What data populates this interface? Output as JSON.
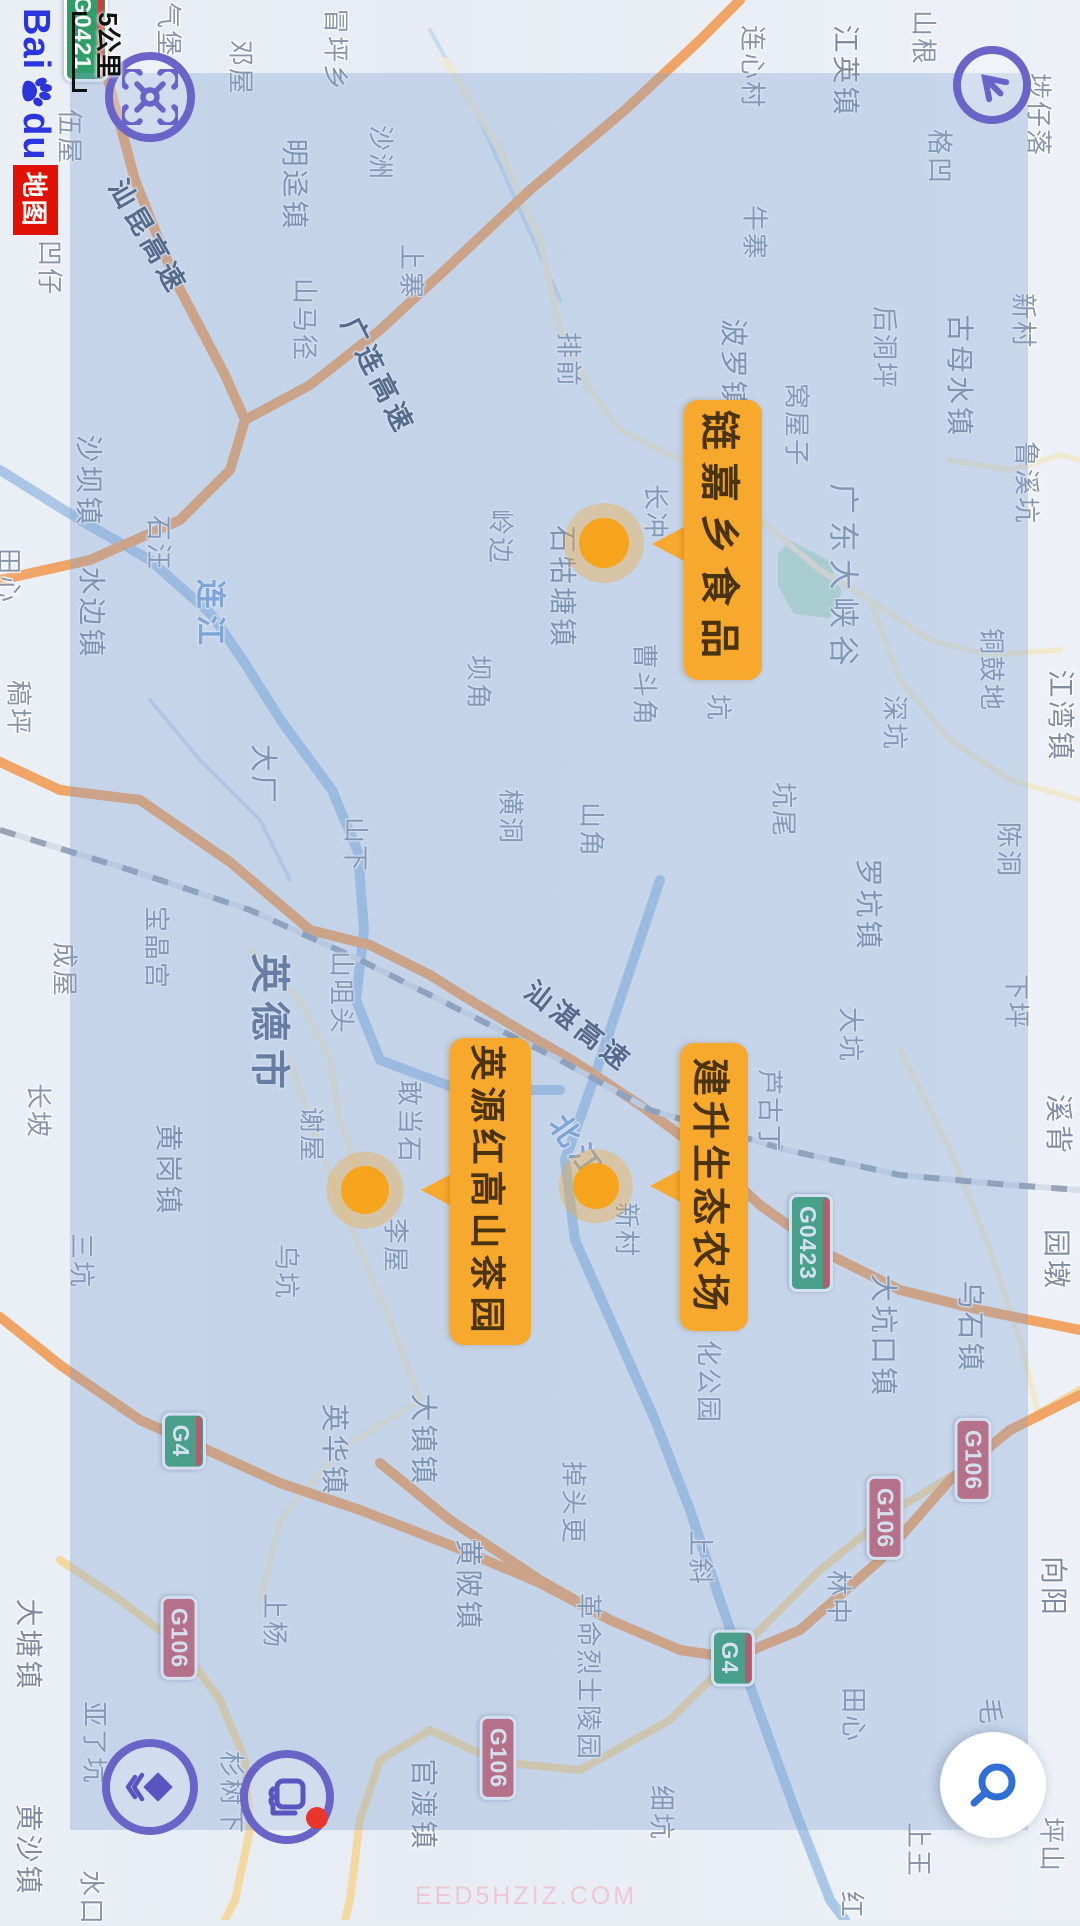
{
  "app": {
    "brand": {
      "bai": "Bai",
      "du": "du",
      "suffix": "地图"
    },
    "scale_label": "5公里",
    "watermark": "EED5HZIZ.COM"
  },
  "colors": {
    "accent_purple": "#6a64c8",
    "poi_orange": "#f7a92d",
    "marker_orange": "#f7a41d",
    "shield_green": "#2f9e68",
    "shield_red": "#cf5a66",
    "search_blue": "#2f6fd6",
    "overlay_blue": "rgba(125,160,208,0.33)",
    "notify_red": "#e8362c"
  },
  "poi_callouts": [
    {
      "label": "链嘉乡食品",
      "box": {
        "x": 400,
        "y": 318,
        "w": 280,
        "h": 78,
        "fs": 40,
        "ls": 12
      },
      "tri": {
        "x": 544,
        "y": 396
      },
      "marker": {
        "x": 543,
        "y": 476,
        "r": 25
      }
    },
    {
      "label": "英源红高山茶园",
      "box": {
        "x": 1038,
        "y": 549,
        "w": 307,
        "h": 81,
        "fs": 36,
        "ls": 6
      },
      "tri": {
        "x": 1190,
        "y": 627
      },
      "marker": {
        "x": 1190,
        "y": 715,
        "r": 24
      }
    },
    {
      "label": "建升生态农场",
      "box": {
        "x": 1043,
        "y": 332,
        "w": 288,
        "h": 68,
        "fs": 38,
        "ls": 5
      },
      "tri": {
        "x": 1186,
        "y": 398
      },
      "marker": {
        "x": 1186,
        "y": 484,
        "r": 23
      }
    }
  ],
  "road_shields": [
    {
      "code": "G0421",
      "type": "exp",
      "x": 33,
      "y": 994
    },
    {
      "code": "G0423",
      "type": "exp",
      "x": 1243,
      "y": 269
    },
    {
      "code": "G4",
      "type": "exp",
      "x": 1441,
      "y": 896
    },
    {
      "code": "G4",
      "type": "exp",
      "x": 1658,
      "y": 347
    },
    {
      "code": "G106",
      "type": "nat",
      "x": 1638,
      "y": 901
    },
    {
      "code": "G106",
      "type": "nat",
      "x": 1758,
      "y": 582
    },
    {
      "code": "G106",
      "type": "nat",
      "x": 1460,
      "y": 107
    },
    {
      "code": "G106",
      "type": "nat",
      "x": 1518,
      "y": 195
    }
  ],
  "map_labels": [
    {
      "t": "邓屋",
      "x": 68,
      "y": 838,
      "c": "v"
    },
    {
      "t": "伍屋",
      "x": 137,
      "y": 1009,
      "c": "v"
    },
    {
      "t": "凹仔",
      "x": 268,
      "y": 1029,
      "c": "v"
    },
    {
      "t": "气堡",
      "x": 30,
      "y": 910,
      "c": "v"
    },
    {
      "t": "冒坪乡",
      "x": 50,
      "y": 743,
      "c": "v"
    },
    {
      "t": "沙洲",
      "x": 153,
      "y": 698,
      "c": "v"
    },
    {
      "t": "山马径",
      "x": 320,
      "y": 774,
      "c": "v"
    },
    {
      "t": "上寨",
      "x": 272,
      "y": 667,
      "c": "v"
    },
    {
      "t": "排前",
      "x": 360,
      "y": 510,
      "c": "v"
    },
    {
      "t": "牛寨",
      "x": 233,
      "y": 324,
      "c": "v"
    },
    {
      "t": "连心村",
      "x": 67,
      "y": 326,
      "c": "v"
    },
    {
      "t": "山根",
      "x": 38,
      "y": 155,
      "c": "v"
    },
    {
      "t": "埗仔落",
      "x": 115,
      "y": 40,
      "c": "v"
    },
    {
      "t": "格凹",
      "x": 157,
      "y": 139,
      "c": "v"
    },
    {
      "t": "新村",
      "x": 321,
      "y": 55,
      "c": "v"
    },
    {
      "t": "古母水镇",
      "x": 376,
      "y": 119,
      "c": "t"
    },
    {
      "t": "后洞坪",
      "x": 348,
      "y": 194,
      "c": "v"
    },
    {
      "t": "鲁溪坑",
      "x": 483,
      "y": 52,
      "c": "v"
    },
    {
      "t": "窝屋子",
      "x": 425,
      "y": 282,
      "c": "v"
    },
    {
      "t": "波罗镇",
      "x": 365,
      "y": 345,
      "c": "t"
    },
    {
      "t": "长冲",
      "x": 512,
      "y": 423,
      "c": "v"
    },
    {
      "t": "石牯塘镇",
      "x": 587,
      "y": 516,
      "c": "t"
    },
    {
      "t": "岭边",
      "x": 537,
      "y": 578,
      "c": "v"
    },
    {
      "t": "广东大峡谷",
      "x": 578,
      "y": 234,
      "c": "a"
    },
    {
      "t": "铜鼓地",
      "x": 670,
      "y": 87,
      "c": "v"
    },
    {
      "t": "深坑",
      "x": 723,
      "y": 184,
      "c": "v"
    },
    {
      "t": "江湾镇",
      "x": 716,
      "y": 18,
      "c": "t"
    },
    {
      "t": "坑尾",
      "x": 810,
      "y": 295,
      "c": "v"
    },
    {
      "t": "陈洞",
      "x": 850,
      "y": 70,
      "c": "v"
    },
    {
      "t": "罗坑镇",
      "x": 905,
      "y": 210,
      "c": "t"
    },
    {
      "t": "下坪",
      "x": 1002,
      "y": 62,
      "c": "v"
    },
    {
      "t": "大坑",
      "x": 1035,
      "y": 228,
      "c": "v"
    },
    {
      "t": "溪背",
      "x": 1125,
      "y": 20,
      "c": "t"
    },
    {
      "t": "园墩",
      "x": 1260,
      "y": 22,
      "c": "t"
    },
    {
      "t": "大坑口镇",
      "x": 1336,
      "y": 195,
      "c": "t"
    },
    {
      "t": "乌石镇",
      "x": 1327,
      "y": 108,
      "c": "t"
    },
    {
      "t": "向阳",
      "x": 1587,
      "y": 25,
      "c": "t"
    },
    {
      "t": "林中",
      "x": 1598,
      "y": 240,
      "c": "v"
    },
    {
      "t": "细坑",
      "x": 1813,
      "y": 417,
      "c": "v"
    },
    {
      "t": "田心",
      "x": 1715,
      "y": 225,
      "c": "v"
    },
    {
      "t": "毛",
      "x": 1712,
      "y": 88,
      "c": "v"
    },
    {
      "t": "上王",
      "x": 1850,
      "y": 160,
      "c": "v"
    },
    {
      "t": "坪山",
      "x": 1845,
      "y": 27,
      "c": "v"
    },
    {
      "t": "红",
      "x": 1905,
      "y": 227,
      "c": "v"
    },
    {
      "t": "掉头更",
      "x": 1503,
      "y": 505,
      "c": "v"
    },
    {
      "t": "上斜",
      "x": 1558,
      "y": 378,
      "c": "v"
    },
    {
      "t": "革命烈士陵园",
      "x": 1677,
      "y": 490,
      "c": "v"
    },
    {
      "t": "官渡镇",
      "x": 1805,
      "y": 655,
      "c": "t"
    },
    {
      "t": "黄陂镇",
      "x": 1585,
      "y": 610,
      "c": "t"
    },
    {
      "t": "大镇镇",
      "x": 1440,
      "y": 655,
      "c": "t"
    },
    {
      "t": "英华镇",
      "x": 1450,
      "y": 744,
      "c": "t"
    },
    {
      "t": "上杨",
      "x": 1621,
      "y": 804,
      "c": "v"
    },
    {
      "t": "杉树下",
      "x": 1793,
      "y": 847,
      "c": "v"
    },
    {
      "t": "亚了坑",
      "x": 1743,
      "y": 984,
      "c": "v"
    },
    {
      "t": "黄沙镇",
      "x": 1850,
      "y": 1050,
      "c": "t"
    },
    {
      "t": "大塘镇",
      "x": 1645,
      "y": 1050,
      "c": "t"
    },
    {
      "t": "水口",
      "x": 1898,
      "y": 987,
      "c": "v"
    },
    {
      "t": "三坑",
      "x": 1261,
      "y": 997,
      "c": "v"
    },
    {
      "t": "乌坑",
      "x": 1272,
      "y": 792,
      "c": "v"
    },
    {
      "t": "黄岗镇",
      "x": 1170,
      "y": 910,
      "c": "t"
    },
    {
      "t": "李屋",
      "x": 1246,
      "y": 683,
      "c": "v"
    },
    {
      "t": "敢当石",
      "x": 1122,
      "y": 669,
      "c": "v"
    },
    {
      "t": "谢屋",
      "x": 1135,
      "y": 767,
      "c": "v"
    },
    {
      "t": "新村",
      "x": 1230,
      "y": 452,
      "c": "v"
    },
    {
      "t": "芦古丁",
      "x": 1111,
      "y": 309,
      "c": "v"
    },
    {
      "t": "化公园",
      "x": 1382,
      "y": 370,
      "c": "v"
    },
    {
      "t": "横洞",
      "x": 817,
      "y": 568,
      "c": "v"
    },
    {
      "t": "山角",
      "x": 830,
      "y": 487,
      "c": "v"
    },
    {
      "t": "坝角",
      "x": 683,
      "y": 600,
      "c": "v"
    },
    {
      "t": "曹斗角",
      "x": 685,
      "y": 434,
      "c": "v"
    },
    {
      "t": "坑",
      "x": 708,
      "y": 360,
      "c": "v"
    },
    {
      "t": "山下",
      "x": 845,
      "y": 723,
      "c": "v"
    },
    {
      "t": "大厂",
      "x": 775,
      "y": 815,
      "c": "t"
    },
    {
      "t": "英德市",
      "x": 1025,
      "y": 807,
      "c": "c"
    },
    {
      "t": "山咀头",
      "x": 993,
      "y": 737,
      "c": "v"
    },
    {
      "t": "宝晶宫",
      "x": 948,
      "y": 922,
      "c": "v"
    },
    {
      "t": "成屋",
      "x": 970,
      "y": 1014,
      "c": "v"
    },
    {
      "t": "长坡",
      "x": 1111,
      "y": 1040,
      "c": "v"
    },
    {
      "t": "稿坪",
      "x": 708,
      "y": 1060,
      "c": "v"
    },
    {
      "t": "田心",
      "x": 576,
      "y": 1070,
      "c": "v"
    },
    {
      "t": "水边镇",
      "x": 613,
      "y": 987,
      "c": "t"
    },
    {
      "t": "沙坝镇",
      "x": 481,
      "y": 990,
      "c": "t"
    },
    {
      "t": "石汪",
      "x": 543,
      "y": 920,
      "c": "v"
    },
    {
      "t": "明迳镇",
      "x": 185,
      "y": 784,
      "c": "t"
    },
    {
      "t": "江英镇",
      "x": 71,
      "y": 233,
      "c": "t"
    },
    {
      "t": "连江",
      "x": 615,
      "y": 867,
      "c": "w"
    },
    {
      "t": "北江",
      "x": 1146,
      "y": 501,
      "c": "w",
      "r": -35
    },
    {
      "t": "汕昆高速",
      "x": 236,
      "y": 930,
      "c": "e",
      "r": -30
    },
    {
      "t": "广连高速",
      "x": 375,
      "y": 700,
      "c": "e",
      "r": -27
    },
    {
      "t": "汕湛高速",
      "x": 1025,
      "y": 500,
      "c": "e",
      "r": -52
    }
  ],
  "roads": [
    {
      "cls": "road-exp",
      "pts": [
        [
          0,
          985
        ],
        [
          80,
          972
        ],
        [
          180,
          945
        ],
        [
          280,
          905
        ],
        [
          375,
          855
        ],
        [
          420,
          835
        ],
        [
          470,
          850
        ],
        [
          520,
          900
        ],
        [
          560,
          990
        ],
        [
          580,
          1080
        ]
      ]
    },
    {
      "cls": "road-exp",
      "pts": [
        [
          420,
          835
        ],
        [
          385,
          770
        ],
        [
          330,
          700
        ],
        [
          270,
          635
        ],
        [
          190,
          550
        ],
        [
          110,
          455
        ],
        [
          40,
          380
        ],
        [
          0,
          340
        ]
      ]
    },
    {
      "cls": "road-exp",
      "pts": [
        [
          762,
          1080
        ],
        [
          790,
          1020
        ],
        [
          800,
          940
        ],
        [
          862,
          850
        ],
        [
          930,
          770
        ],
        [
          945,
          710
        ],
        [
          975,
          650
        ],
        [
          1000,
          610
        ],
        [
          1030,
          560
        ],
        [
          1062,
          505
        ],
        [
          1105,
          440
        ],
        [
          1150,
          380
        ],
        [
          1205,
          320
        ],
        [
          1255,
          250
        ],
        [
          1290,
          180
        ],
        [
          1310,
          100
        ],
        [
          1330,
          0
        ]
      ]
    },
    {
      "cls": "road-exp",
      "pts": [
        [
          1463,
          700
        ],
        [
          1520,
          630
        ],
        [
          1580,
          540
        ],
        [
          1620,
          470
        ],
        [
          1650,
          400
        ],
        [
          1658,
          347
        ],
        [
          1630,
          280
        ],
        [
          1560,
          200
        ],
        [
          1480,
          130
        ],
        [
          1430,
          70
        ],
        [
          1395,
          0
        ]
      ]
    },
    {
      "cls": "road-exp",
      "pts": [
        [
          1317,
          1080
        ],
        [
          1365,
          1020
        ],
        [
          1420,
          940
        ],
        [
          1448,
          877
        ],
        [
          1483,
          800
        ],
        [
          1510,
          720
        ],
        [
          1545,
          630
        ],
        [
          1583,
          540
        ],
        [
          1620,
          470
        ]
      ]
    },
    {
      "cls": "road-nat",
      "pts": [
        [
          1560,
          1020
        ],
        [
          1600,
          960
        ],
        [
          1645,
          901
        ],
        [
          1700,
          860
        ],
        [
          1760,
          835
        ],
        [
          1830,
          830
        ],
        [
          1900,
          845
        ],
        [
          1920,
          855
        ]
      ]
    },
    {
      "cls": "road-nat",
      "pts": [
        [
          1390,
          0
        ],
        [
          1430,
          70
        ],
        [
          1465,
          110
        ],
        [
          1510,
          185
        ],
        [
          1570,
          260
        ],
        [
          1640,
          330
        ],
        [
          1720,
          410
        ],
        [
          1770,
          500
        ],
        [
          1762,
          582
        ],
        [
          1730,
          650
        ],
        [
          1760,
          700
        ],
        [
          1820,
          720
        ],
        [
          1900,
          730
        ],
        [
          1920,
          735
        ]
      ]
    },
    {
      "cls": "road-min",
      "pts": [
        [
          60,
          635
        ],
        [
          150,
          580
        ],
        [
          240,
          540
        ],
        [
          330,
          520
        ],
        [
          390,
          490
        ],
        [
          430,
          460
        ]
      ]
    },
    {
      "cls": "road-min",
      "pts": [
        [
          430,
          460
        ],
        [
          470,
          380
        ],
        [
          520,
          320
        ],
        [
          570,
          260
        ],
        [
          600,
          210
        ],
        [
          640,
          150
        ],
        [
          655,
          90
        ],
        [
          650,
          20
        ]
      ]
    },
    {
      "cls": "road-min",
      "pts": [
        [
          600,
          210
        ],
        [
          680,
          180
        ],
        [
          740,
          130
        ],
        [
          780,
          70
        ],
        [
          800,
          0
        ]
      ]
    },
    {
      "cls": "road-min",
      "pts": [
        [
          1060,
          790
        ],
        [
          1150,
          760
        ],
        [
          1250,
          720
        ],
        [
          1320,
          690
        ],
        [
          1400,
          660
        ],
        [
          1450,
          740
        ],
        [
          1520,
          800
        ],
        [
          1600,
          820
        ]
      ]
    },
    {
      "cls": "road-min",
      "pts": [
        [
          1050,
          180
        ],
        [
          1150,
          130
        ],
        [
          1250,
          90
        ],
        [
          1340,
          60
        ],
        [
          1420,
          40
        ]
      ]
    },
    {
      "cls": "road-min",
      "pts": [
        [
          950,
          830
        ],
        [
          1000,
          780
        ],
        [
          1060,
          750
        ],
        [
          1120,
          740
        ],
        [
          1180,
          720
        ]
      ]
    },
    {
      "cls": "road-min",
      "pts": [
        [
          460,
          130
        ],
        [
          470,
          70
        ],
        [
          455,
          20
        ],
        [
          460,
          0
        ]
      ]
    }
  ],
  "rivers": [
    {
      "cls": "river",
      "pts": [
        [
          470,
          1080
        ],
        [
          520,
          1000
        ],
        [
          560,
          930
        ],
        [
          615,
          868
        ],
        [
          662,
          836
        ],
        [
          722,
          798
        ],
        [
          790,
          748
        ],
        [
          852,
          722
        ],
        [
          930,
          716
        ],
        [
          1000,
          724
        ],
        [
          1060,
          700
        ],
        [
          1090,
          620
        ],
        [
          1090,
          520
        ]
      ]
    },
    {
      "cls": "river",
      "pts": [
        [
          880,
          420
        ],
        [
          940,
          440
        ],
        [
          1000,
          460
        ],
        [
          1090,
          490
        ],
        [
          1160,
          515
        ],
        [
          1240,
          505
        ],
        [
          1330,
          465
        ],
        [
          1420,
          425
        ],
        [
          1510,
          390
        ],
        [
          1600,
          360
        ],
        [
          1700,
          325
        ],
        [
          1810,
          285
        ],
        [
          1900,
          250
        ],
        [
          1920,
          235
        ]
      ]
    },
    {
      "cls": "stream",
      "pts": [
        [
          30,
          650
        ],
        [
          120,
          600
        ],
        [
          210,
          560
        ],
        [
          300,
          520
        ]
      ]
    },
    {
      "cls": "stream",
      "pts": [
        [
          700,
          930
        ],
        [
          760,
          880
        ],
        [
          820,
          820
        ],
        [
          880,
          790
        ]
      ]
    }
  ],
  "railway": {
    "pts": [
      [
        830,
        1080
      ],
      [
        870,
        950
      ],
      [
        910,
        830
      ],
      [
        960,
        720
      ],
      [
        1005,
        630
      ],
      [
        1060,
        520
      ],
      [
        1110,
        430
      ],
      [
        1150,
        293
      ],
      [
        1175,
        180
      ],
      [
        1185,
        70
      ],
      [
        1190,
        0
      ]
    ]
  },
  "park": {
    "pts": [
      [
        540,
        290
      ],
      [
        560,
        252
      ],
      [
        592,
        238
      ],
      [
        618,
        250
      ],
      [
        614,
        286
      ],
      [
        586,
        302
      ],
      [
        554,
        302
      ]
    ]
  },
  "overlay_rect": {
    "x": 73,
    "y": 52,
    "w": 1757,
    "h": 958
  }
}
